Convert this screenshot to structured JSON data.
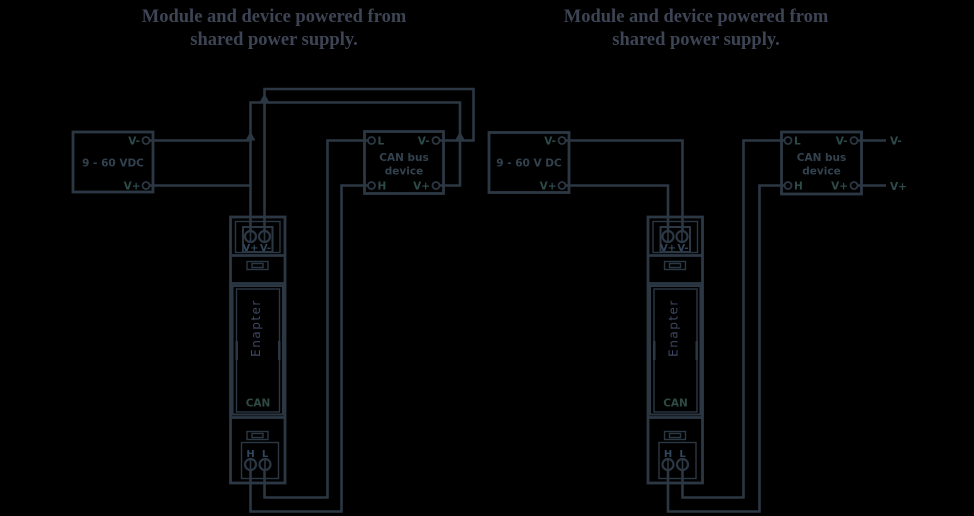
{
  "colors": {
    "background": "#000000",
    "line": "#2c3744",
    "terminal_label": "#2e4a49"
  },
  "left": {
    "title_line1": "Module and device powered from",
    "title_line2": "shared power supply.",
    "psu_label": "9 - 60 VDC",
    "psu_vminus": "V-",
    "psu_vplus": "V+",
    "device_line1": "CAN bus",
    "device_line2": "device",
    "device_l": "L",
    "device_h": "H",
    "device_vminus": "V-",
    "device_vplus": "V+",
    "module": {
      "brand": "Enapter",
      "port": "CAN",
      "vplus": "V+",
      "vminus": "V-",
      "h": "H",
      "l": "L"
    }
  },
  "right": {
    "title_line1": "Module and device powered from",
    "title_line2": "shared power supply.",
    "psu_label": "9 - 60 V DC",
    "psu_vminus": "V-",
    "psu_vplus": "V+",
    "device_line1": "CAN bus",
    "device_line2": "device",
    "device_l": "L",
    "device_h": "H",
    "device_vminus": "V-",
    "device_vplus": "V+",
    "net_vminus": "V-",
    "net_vplus": "V+",
    "module": {
      "brand": "Enapter",
      "port": "CAN",
      "vplus": "V+",
      "vminus": "V-",
      "h": "H",
      "l": "L"
    }
  }
}
